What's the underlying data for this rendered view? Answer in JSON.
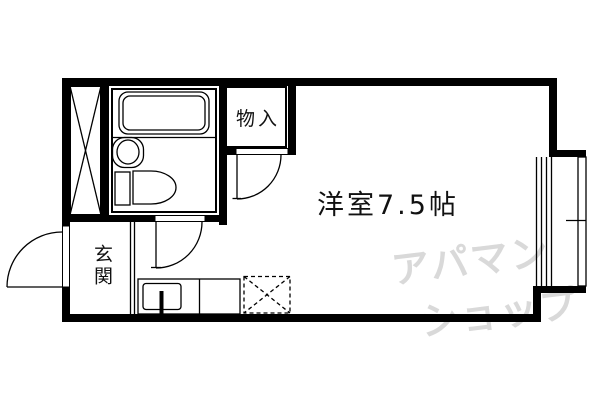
{
  "plan": {
    "labels": {
      "main_room": "洋室7.5帖",
      "storage": "物入",
      "entrance": "玄関"
    },
    "watermark": {
      "line1": "アパマン",
      "line2": "ショップ"
    }
  },
  "colors": {
    "line": "#000000",
    "background": "#ffffff",
    "watermark": "#d9d9d9",
    "text": "#111111"
  }
}
